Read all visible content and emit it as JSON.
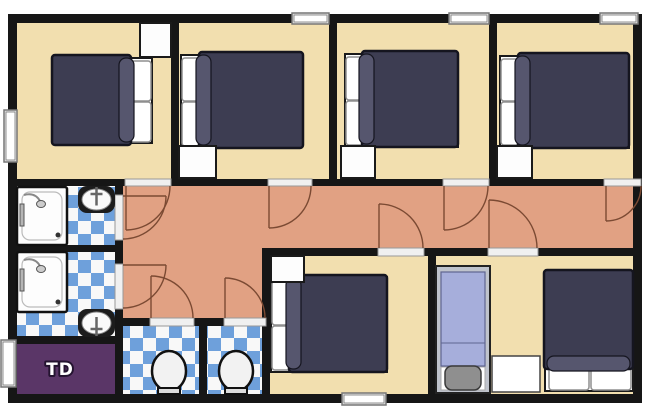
{
  "title": "apartment-floor-plan",
  "canvas": {
    "w": 650,
    "h": 420,
    "background": "#ffffff"
  },
  "palette": {
    "wall": "#161616",
    "floor_bedroom": "#F2DFAF",
    "floor_corridor": "#E1A183",
    "tile_blue": "#6EA0DB",
    "tile_white": "#F8F8F8",
    "utility_purple": "#5A3667",
    "duvet": "#3D3D52",
    "duvet_fold": "#56566E",
    "duvet_edge": "#15151F",
    "pillow": "#FFFFFF",
    "pillow_edge": "#8F8F8F",
    "mattress": "#FFFFFF",
    "mattress_edge": "#1A1A1A",
    "door_arc": "#7B4A33",
    "doorway_fill": "#F0F0F0",
    "doorway_edge": "#999999",
    "window_fill": "#E8E8E8",
    "window_pane": "#FFFFFF",
    "window_edge": "#777777",
    "fixture_fill": "#FDFDFD",
    "fixture_edge": "#111111",
    "metal": "#999999",
    "single_frame": "#BFC3CC",
    "single_blanket": "#A6AEDB",
    "single_pillow": "#8F8F8F",
    "label_text": "#FFFFFF",
    "label_outline": "#241430"
  },
  "rooms": [
    {
      "name": "bedroom-1",
      "floor": "bedroom",
      "rect": [
        17,
        23,
        154,
        156
      ],
      "label": ""
    },
    {
      "name": "bedroom-2",
      "floor": "bedroom",
      "rect": [
        179,
        23,
        150,
        156
      ],
      "label": ""
    },
    {
      "name": "bedroom-3",
      "floor": "bedroom",
      "rect": [
        337,
        23,
        152,
        156
      ],
      "label": ""
    },
    {
      "name": "bedroom-4",
      "floor": "bedroom",
      "rect": [
        497,
        23,
        136,
        156
      ],
      "label": ""
    },
    {
      "name": "corridor-main",
      "floor": "corridor",
      "rect": [
        123,
        186,
        510,
        62
      ],
      "label": ""
    },
    {
      "name": "corridor-branch",
      "floor": "corridor",
      "rect": [
        123,
        186,
        139,
        132
      ],
      "label": ""
    },
    {
      "name": "bathroom-1",
      "floor": "tiles",
      "rect": [
        17,
        187,
        98,
        58
      ],
      "label": ""
    },
    {
      "name": "bathroom-2",
      "floor": "tiles",
      "rect": [
        17,
        252,
        98,
        84
      ],
      "label": ""
    },
    {
      "name": "utility-room-td",
      "floor": "purple",
      "rect": [
        17,
        344,
        98,
        50
      ],
      "label": "TD"
    },
    {
      "name": "wc-1",
      "floor": "tiles",
      "rect": [
        123,
        326,
        76,
        68
      ],
      "label": ""
    },
    {
      "name": "wc-2",
      "floor": "tiles",
      "rect": [
        207,
        326,
        55,
        68
      ],
      "label": ""
    },
    {
      "name": "bedroom-5",
      "floor": "bedroom",
      "rect": [
        270,
        256,
        158,
        138
      ],
      "label": ""
    },
    {
      "name": "bedroom-6",
      "floor": "bedroom",
      "rect": [
        436,
        256,
        197,
        138
      ],
      "label": ""
    }
  ],
  "walls": [
    [
      8,
      14,
      634,
      9
    ],
    [
      8,
      394,
      634,
      9
    ],
    [
      8,
      14,
      9,
      389
    ],
    [
      633,
      14,
      9,
      389
    ],
    [
      171,
      14,
      8,
      172
    ],
    [
      329,
      14,
      8,
      172
    ],
    [
      489,
      14,
      8,
      172
    ],
    [
      8,
      179,
      634,
      7
    ],
    [
      115,
      179,
      8,
      215
    ],
    [
      8,
      245,
      107,
      7
    ],
    [
      8,
      336,
      107,
      8
    ],
    [
      115,
      318,
      155,
      8
    ],
    [
      199,
      318,
      8,
      76
    ],
    [
      262,
      248,
      380,
      8
    ],
    [
      262,
      248,
      8,
      146
    ],
    [
      428,
      248,
      8,
      146
    ]
  ],
  "doorways": [
    {
      "name": "doorway-bedroom-1",
      "rect": [
        125,
        179,
        46,
        7
      ]
    },
    {
      "name": "doorway-bedroom-2",
      "rect": [
        268,
        179,
        44,
        7
      ]
    },
    {
      "name": "doorway-bedroom-3",
      "rect": [
        443,
        179,
        46,
        7
      ]
    },
    {
      "name": "doorway-bedroom-4",
      "rect": [
        604,
        179,
        37,
        7
      ]
    },
    {
      "name": "doorway-bathroom-1",
      "rect": [
        115,
        195,
        8,
        45
      ]
    },
    {
      "name": "doorway-bathroom-2",
      "rect": [
        115,
        264,
        8,
        45
      ]
    },
    {
      "name": "doorway-wc-1",
      "rect": [
        150,
        318,
        44,
        8
      ]
    },
    {
      "name": "doorway-wc-2",
      "rect": [
        224,
        318,
        42,
        8
      ]
    },
    {
      "name": "doorway-bedroom-5",
      "rect": [
        378,
        248,
        46,
        8
      ]
    },
    {
      "name": "doorway-bedroom-6",
      "rect": [
        488,
        248,
        50,
        8
      ]
    }
  ],
  "door_arcs": [
    {
      "name": "door-bedroom-1",
      "leaf": [
        126,
        186,
        126,
        230
      ],
      "start": [
        126,
        230
      ],
      "end": [
        170,
        186
      ],
      "r": 44,
      "sweep": 0
    },
    {
      "name": "door-bedroom-2",
      "leaf": [
        269,
        186,
        269,
        228
      ],
      "start": [
        269,
        228
      ],
      "end": [
        311,
        186
      ],
      "r": 42,
      "sweep": 0
    },
    {
      "name": "door-bedroom-3",
      "leaf": [
        444,
        186,
        444,
        230
      ],
      "start": [
        444,
        230
      ],
      "end": [
        488,
        186
      ],
      "r": 44,
      "sweep": 0
    },
    {
      "name": "door-bedroom-4",
      "leaf": [
        606,
        186,
        606,
        221
      ],
      "start": [
        606,
        221
      ],
      "end": [
        641,
        186
      ],
      "r": 35,
      "sweep": 0
    },
    {
      "name": "door-bathroom-1",
      "leaf": [
        123,
        196,
        166,
        196
      ],
      "start": [
        166,
        196
      ],
      "end": [
        123,
        239
      ],
      "r": 43,
      "sweep": 1
    },
    {
      "name": "door-bathroom-2",
      "leaf": [
        123,
        265,
        166,
        265
      ],
      "start": [
        166,
        265
      ],
      "end": [
        123,
        308
      ],
      "r": 43,
      "sweep": 1
    },
    {
      "name": "door-wc-1",
      "leaf": [
        151,
        318,
        151,
        276
      ],
      "start": [
        151,
        276
      ],
      "end": [
        193,
        318
      ],
      "r": 42,
      "sweep": 1
    },
    {
      "name": "door-wc-2",
      "leaf": [
        225,
        318,
        225,
        278
      ],
      "start": [
        225,
        278
      ],
      "end": [
        265,
        318
      ],
      "r": 40,
      "sweep": 1
    },
    {
      "name": "door-bedroom-5",
      "leaf": [
        379,
        248,
        379,
        204
      ],
      "start": [
        379,
        204
      ],
      "end": [
        423,
        248
      ],
      "r": 44,
      "sweep": 1
    },
    {
      "name": "door-bedroom-6",
      "leaf": [
        489,
        248,
        489,
        200
      ],
      "start": [
        489,
        200
      ],
      "end": [
        537,
        248
      ],
      "r": 48,
      "sweep": 1
    }
  ],
  "windows": [
    {
      "name": "window-bedroom-1",
      "rect": [
        4,
        110,
        13,
        52
      ]
    },
    {
      "name": "window-bedroom-2",
      "rect": [
        292,
        13,
        37,
        11
      ]
    },
    {
      "name": "window-bedroom-3",
      "rect": [
        449,
        13,
        40,
        11
      ]
    },
    {
      "name": "window-bedroom-4",
      "rect": [
        600,
        13,
        38,
        11
      ]
    },
    {
      "name": "window-utility-td",
      "rect": [
        1,
        340,
        15,
        47
      ]
    },
    {
      "name": "window-bedroom-5",
      "rect": [
        342,
        393,
        44,
        12
      ]
    }
  ],
  "furniture": [
    {
      "type": "double-bed",
      "name": "bed-bedroom-1",
      "mattress": [
        55,
        58,
        97,
        85
      ],
      "pillows": [
        [
          123,
          61,
          28,
          40
        ],
        [
          123,
          102,
          28,
          40
        ]
      ],
      "duvet": [
        52,
        55,
        79,
        90
      ],
      "fold": "right"
    },
    {
      "type": "double-bed",
      "name": "bed-bedroom-2",
      "mattress": [
        181,
        55,
        121,
        92
      ],
      "pillows": [
        [
          182,
          58,
          28,
          43
        ],
        [
          182,
          102,
          28,
          44
        ]
      ],
      "duvet": [
        199,
        52,
        104,
        96
      ],
      "fold": "left"
    },
    {
      "type": "double-bed",
      "name": "bed-bedroom-3",
      "mattress": [
        345,
        54,
        113,
        93
      ],
      "pillows": [
        [
          346,
          57,
          28,
          43
        ],
        [
          346,
          101,
          28,
          44
        ]
      ],
      "duvet": [
        362,
        51,
        96,
        96
      ],
      "fold": "left"
    },
    {
      "type": "double-bed",
      "name": "bed-bedroom-4",
      "mattress": [
        500,
        56,
        129,
        92
      ],
      "pillows": [
        [
          501,
          59,
          28,
          42
        ],
        [
          501,
          102,
          28,
          43
        ]
      ],
      "duvet": [
        518,
        53,
        111,
        95
      ],
      "fold": "left"
    },
    {
      "type": "double-bed",
      "name": "bed-bedroom-5",
      "mattress": [
        271,
        277,
        116,
        95
      ],
      "pillows": [
        [
          272,
          281,
          29,
          44
        ],
        [
          272,
          326,
          29,
          44
        ]
      ],
      "duvet": [
        289,
        275,
        98,
        97
      ],
      "fold": "left"
    },
    {
      "type": "double-bed",
      "name": "bed-bedroom-6",
      "mattress": [
        545,
        272,
        88,
        119
      ],
      "pillows": [
        [
          549,
          362,
          40,
          28
        ],
        [
          591,
          362,
          40,
          28
        ]
      ],
      "duvet": [
        544,
        270,
        89,
        99
      ],
      "fold": "bottom"
    },
    {
      "type": "single-bed",
      "name": "single-bed-bedroom-6",
      "frame": [
        436,
        266,
        54,
        127
      ],
      "blanket": [
        441,
        272,
        44,
        94
      ],
      "seam_y": 343,
      "sheet": [
        441,
        367,
        44,
        23
      ],
      "pillow": [
        445,
        366,
        36,
        24
      ]
    },
    {
      "type": "nightstand",
      "name": "nightstand-bedroom-1",
      "rect": [
        140,
        23,
        31,
        34
      ]
    },
    {
      "type": "nightstand",
      "name": "nightstand-bedroom-2",
      "rect": [
        179,
        146,
        37,
        32
      ]
    },
    {
      "type": "nightstand",
      "name": "nightstand-bedroom-3",
      "rect": [
        341,
        146,
        34,
        32
      ]
    },
    {
      "type": "nightstand",
      "name": "nightstand-bedroom-4",
      "rect": [
        497,
        146,
        35,
        32
      ]
    },
    {
      "type": "nightstand",
      "name": "nightstand-bedroom-5",
      "rect": [
        271,
        256,
        33,
        26
      ]
    },
    {
      "type": "table",
      "name": "table-bedroom-6",
      "rect": [
        492,
        356,
        48,
        36
      ]
    },
    {
      "type": "shower",
      "name": "shower-bathroom-1",
      "tray": [
        17,
        187,
        50,
        58
      ],
      "drain": [
        58,
        235
      ]
    },
    {
      "type": "shower",
      "name": "shower-bathroom-2",
      "tray": [
        17,
        252,
        50,
        60
      ],
      "drain": [
        58,
        302
      ]
    },
    {
      "type": "sink",
      "name": "sink-bathroom-1",
      "frame": [
        78,
        186,
        37,
        27
      ],
      "faucet": "down"
    },
    {
      "type": "sink",
      "name": "sink-bathroom-2",
      "frame": [
        78,
        309,
        37,
        28
      ],
      "faucet": "up"
    },
    {
      "type": "toilet",
      "name": "toilet-wc-1",
      "cx": 169,
      "cy": 371,
      "rx": 17,
      "ry": 20,
      "base": [
        158,
        388,
        22,
        6
      ]
    },
    {
      "type": "toilet",
      "name": "toilet-wc-2",
      "cx": 236,
      "cy": 371,
      "rx": 17,
      "ry": 20,
      "base": [
        225,
        388,
        22,
        6
      ]
    }
  ]
}
